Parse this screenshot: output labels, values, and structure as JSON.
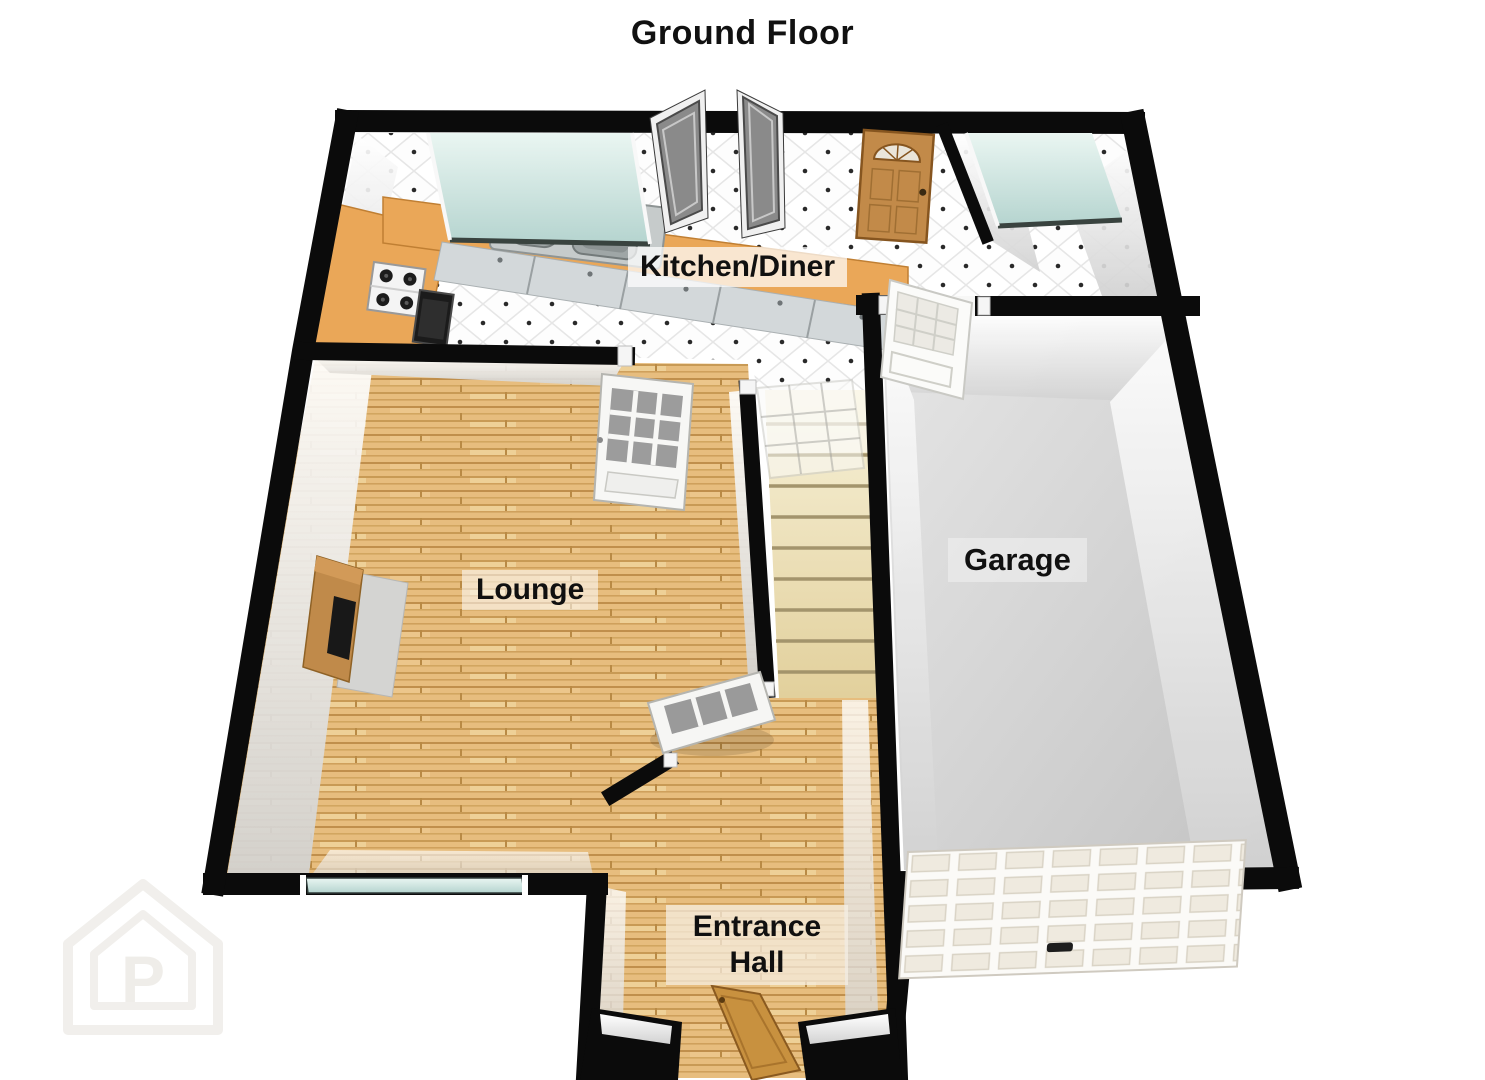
{
  "title": "Ground Floor",
  "floorplan": {
    "rooms": {
      "kitchen_diner": {
        "label": "Kitchen/Diner"
      },
      "lounge": {
        "label": "Lounge"
      },
      "garage": {
        "label": "Garage"
      },
      "entrance_hall": {
        "label": "Entrance Hall",
        "label_line1": "Entrance",
        "label_line2": "Hall"
      }
    }
  },
  "watermark": {
    "letter": "P"
  },
  "colors": {
    "wall": "#0b0b0b",
    "tile_floor": "#fdfdfd",
    "wood_floor": "#e7bd7e",
    "garage_floor": "#d9d9d9",
    "counter": "#eaa758",
    "glass": "#cfe6e1",
    "door_wood": "#c28a49",
    "stairs": "#ead9a8"
  }
}
